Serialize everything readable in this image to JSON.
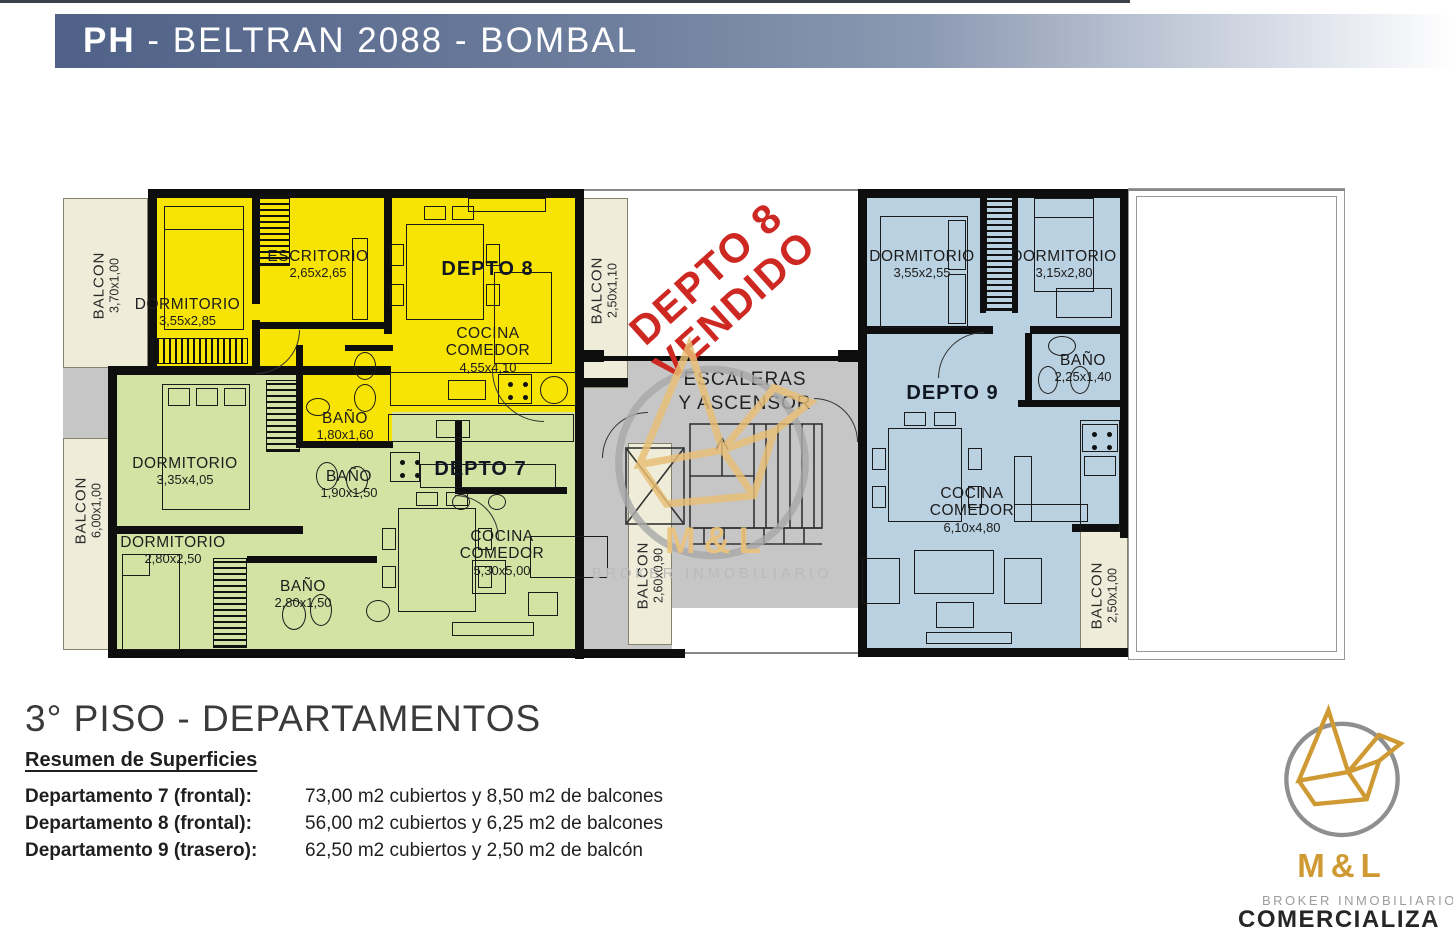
{
  "header": {
    "brand": "PH",
    "rest": " - BELTRAN 2088 - BOMBAL"
  },
  "plan": {
    "sold": {
      "line1": "DEPTO 8",
      "line2": "VENDIDO"
    },
    "core": {
      "line1": "ESCALERAS",
      "line2": "Y ASCENSOR"
    },
    "shared_balconies": {
      "left_top": {
        "name": "BALCON",
        "dims": "3,70x1,00"
      },
      "left_bottom": {
        "name": "BALCON",
        "dims": "6,00x1,00"
      }
    },
    "depto8": {
      "label": "DEPTO 8",
      "rooms": {
        "dormitorio": {
          "name": "DORMITORIO",
          "dims": "3,55x2,85"
        },
        "escritorio": {
          "name": "ESCRITORIO",
          "dims": "2,65x2,65"
        },
        "cocina": {
          "name": "COCINA COMEDOR",
          "dims": "4,55x4,10"
        },
        "bano": {
          "name": "BAÑO",
          "dims": "1,80x1,60"
        },
        "balcon": {
          "name": "BALCON",
          "dims": "2,50x1,10"
        }
      }
    },
    "depto7": {
      "label": "DEPTO 7",
      "rooms": {
        "dorm1": {
          "name": "DORMITORIO",
          "dims": "3,35x4,05"
        },
        "dorm2": {
          "name": "DORMITORIO",
          "dims": "2,80x2,50"
        },
        "bano1": {
          "name": "BAÑO",
          "dims": "1,90x1,50"
        },
        "bano2": {
          "name": "BAÑO",
          "dims": "2,80x1,50"
        },
        "cocina": {
          "name": "COCINA COMEDOR",
          "dims": "5,30x5,00"
        },
        "balcon": {
          "name": "BALCON",
          "dims": "2,60x0,90"
        }
      }
    },
    "depto9": {
      "label": "DEPTO 9",
      "rooms": {
        "dorm1": {
          "name": "DORMITORIO",
          "dims": "3,55x2,55"
        },
        "dorm2": {
          "name": "DORMITORIO",
          "dims": "3,15x2,80"
        },
        "bano": {
          "name": "BAÑO",
          "dims": "2,25x1,40"
        },
        "cocina": {
          "name": "COCINA COMEDOR",
          "dims": "6,10x4,80"
        },
        "balcon": {
          "name": "BALCON",
          "dims": "2,50x1,00"
        }
      }
    },
    "colors": {
      "depto7_green": "#D3E3A4",
      "depto8_yellow": "#F8E402",
      "depto9_blue": "#B9D1E0",
      "balcony_cream": "#EFEDDA",
      "core_grey": "#C6C6C6",
      "sold_red": "#CD2922",
      "brand_gold": "#CF9A33"
    }
  },
  "watermark": {
    "name": "M&L",
    "subtitle": "BROKER INMOBILIARIO"
  },
  "footer": {
    "title": "3° PISO - DEPARTAMENTOS",
    "subtitle": "Resumen de Superficies",
    "rows": [
      {
        "label": "Departamento 7 (frontal):",
        "value": "73,00 m2 cubiertos y 8,50 m2 de balcones"
      },
      {
        "label": "Departamento 8 (frontal):",
        "value": "56,00 m2 cubiertos y 6,25 m2 de balcones"
      },
      {
        "label": "Departamento 9 (trasero):",
        "value": "62,50 m2 cubiertos y 2,50 m2 de balcón"
      }
    ]
  },
  "logo": {
    "name": "M&L",
    "subtitle": "BROKER INMOBILIARIO",
    "tagline": "COMERCIALIZA"
  }
}
